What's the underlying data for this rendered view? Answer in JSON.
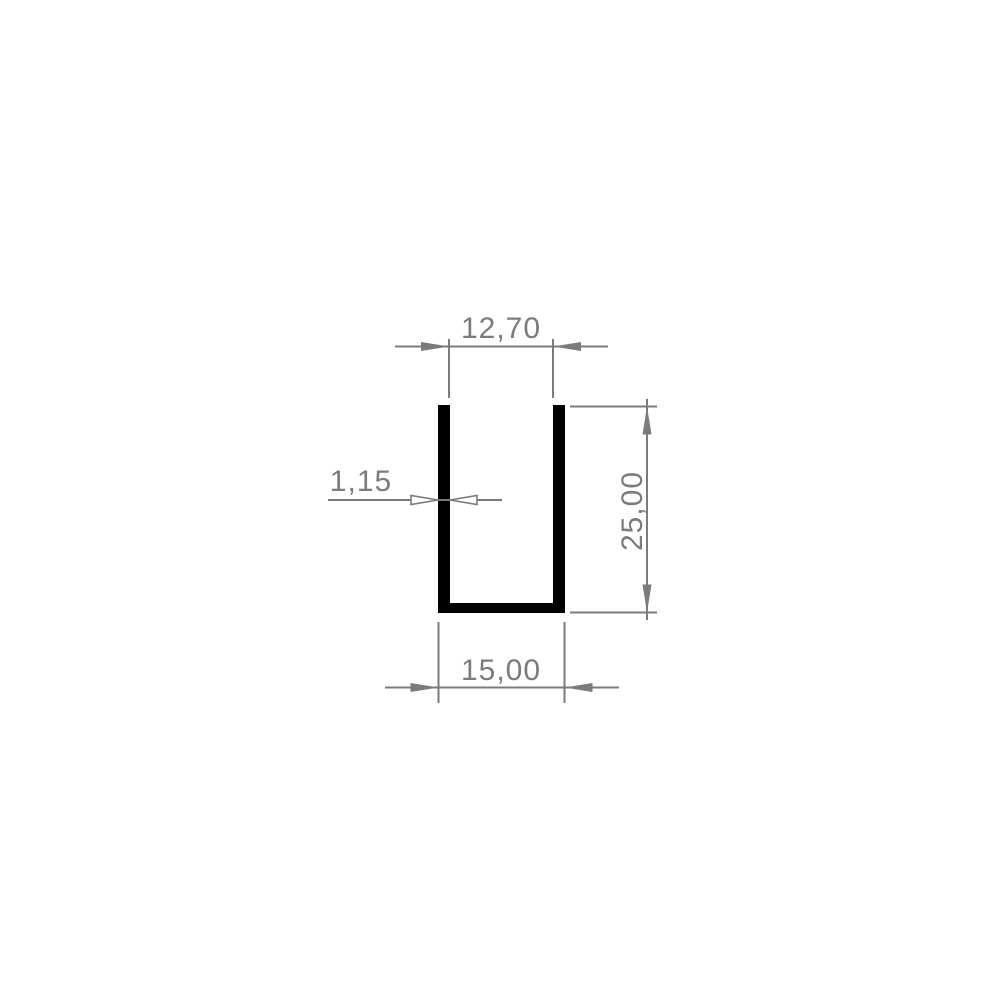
{
  "drawing": {
    "background_color": "#ffffff",
    "profile_color": "#000000",
    "dimension_color": "#7b7b7d",
    "dimensions": {
      "inner_width": {
        "label": "12,70",
        "value": 12.7
      },
      "wall_thickness": {
        "label": "1,15",
        "value": 1.15
      },
      "height": {
        "label": "25,00",
        "value": 25.0
      },
      "outer_width": {
        "label": "15,00",
        "value": 15.0
      }
    }
  }
}
